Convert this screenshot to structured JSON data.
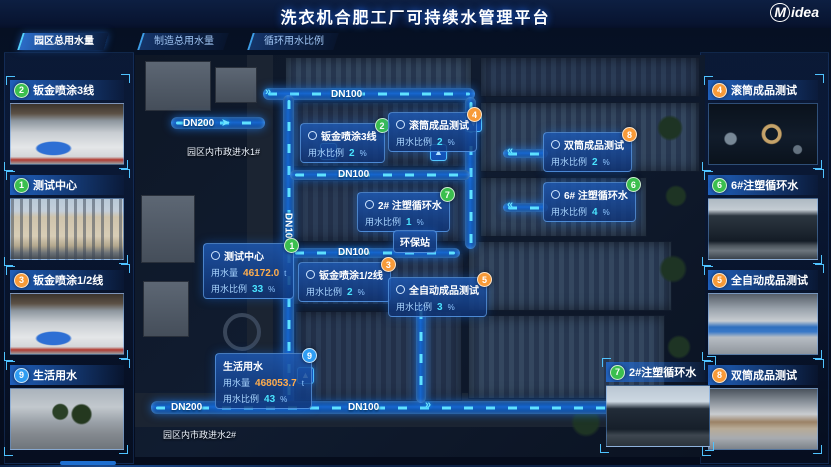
{
  "header": {
    "title": "洗衣机合肥工厂可持续水管理平台",
    "brand_m": "M",
    "brand_rest": "idea"
  },
  "tabs": [
    {
      "label": "园区总用水量",
      "active": true
    },
    {
      "label": "制造总用水量",
      "active": false
    },
    {
      "label": "循环用水比例",
      "active": false
    }
  ],
  "colors": {
    "accent_cyan": "#4ae4ff",
    "pipe_blue": "#1767cf",
    "badge_green": "#3bbf4e",
    "badge_orange": "#f79a38",
    "badge_blue": "#2f9df2",
    "value_orange": "#ffad4d"
  },
  "icons": {
    "chevron_left": "«",
    "chevron_right": "»",
    "arrow_up": "▲",
    "arrow_down": "▼",
    "arrow_right": "➤"
  },
  "left_cards": [
    {
      "label": "钣金喷涂3线",
      "badge": "2",
      "color": "green"
    },
    {
      "label": "测试中心",
      "badge": "1",
      "color": "green"
    },
    {
      "label": "钣金喷涂1/2线",
      "badge": "3",
      "color": "orange"
    },
    {
      "label": "生活用水",
      "badge": "9",
      "color": "blue"
    }
  ],
  "right_cards": [
    {
      "label": "滚筒成品测试",
      "badge": "4",
      "color": "orange"
    },
    {
      "label": "6#注塑循环水",
      "badge": "6",
      "color": "green"
    },
    {
      "label": "全自动成品测试",
      "badge": "5",
      "color": "orange"
    },
    {
      "label": "双筒成品测试",
      "badge": "8",
      "color": "orange"
    }
  ],
  "floating_card": {
    "label": "2#注塑循环水",
    "badge": "7",
    "color": "green"
  },
  "map": {
    "labels": {
      "dn100_top": "DN100",
      "dn200_top": "DN200",
      "inlet1": "园区内市政进水1#",
      "dn100_mid1": "DN100",
      "dn100_vertical": "DN100",
      "dn100_mid2": "DN100",
      "dn200_bottom": "DN200",
      "dn100_bottom": "DN100",
      "inlet2": "园区内市政进水2#",
      "station": "环保站"
    },
    "callouts": [
      {
        "title": "钣金喷涂3线",
        "badge": "2",
        "color": "green",
        "rows": [
          {
            "label": "用水比例",
            "value": "2",
            "unit": "%"
          }
        ]
      },
      {
        "title": "滚筒成品测试",
        "badge": "4",
        "color": "orange",
        "rows": [
          {
            "label": "用水比例",
            "value": "2",
            "unit": "%"
          }
        ]
      },
      {
        "title": "双筒成品测试",
        "badge": "8",
        "color": "orange",
        "rows": [
          {
            "label": "用水比例",
            "value": "2",
            "unit": "%"
          }
        ]
      },
      {
        "title": "2# 注塑循环水",
        "badge": "7",
        "color": "green",
        "rows": [
          {
            "label": "用水比例",
            "value": "1",
            "unit": "%"
          }
        ]
      },
      {
        "title": "6# 注塑循环水",
        "badge": "6",
        "color": "green",
        "rows": [
          {
            "label": "用水比例",
            "value": "4",
            "unit": "%"
          }
        ]
      },
      {
        "title": "测试中心",
        "badge": "1",
        "color": "green",
        "rows": [
          {
            "label": "用水量",
            "value": "46172.0",
            "unit": "t"
          },
          {
            "label": "用水比例",
            "value": "33",
            "unit": "%"
          }
        ]
      },
      {
        "title": "钣金喷涂1/2线",
        "badge": "3",
        "color": "orange",
        "rows": [
          {
            "label": "用水比例",
            "value": "2",
            "unit": "%"
          }
        ]
      },
      {
        "title": "全自动成品测试",
        "badge": "5",
        "color": "orange",
        "rows": [
          {
            "label": "用水比例",
            "value": "3",
            "unit": "%"
          }
        ]
      },
      {
        "title": "生活用水",
        "badge": "9",
        "color": "blue",
        "rows": [
          {
            "label": "用水量",
            "value": "468053.7",
            "unit": "t"
          },
          {
            "label": "用水比例",
            "value": "43",
            "unit": "%"
          }
        ]
      }
    ]
  }
}
